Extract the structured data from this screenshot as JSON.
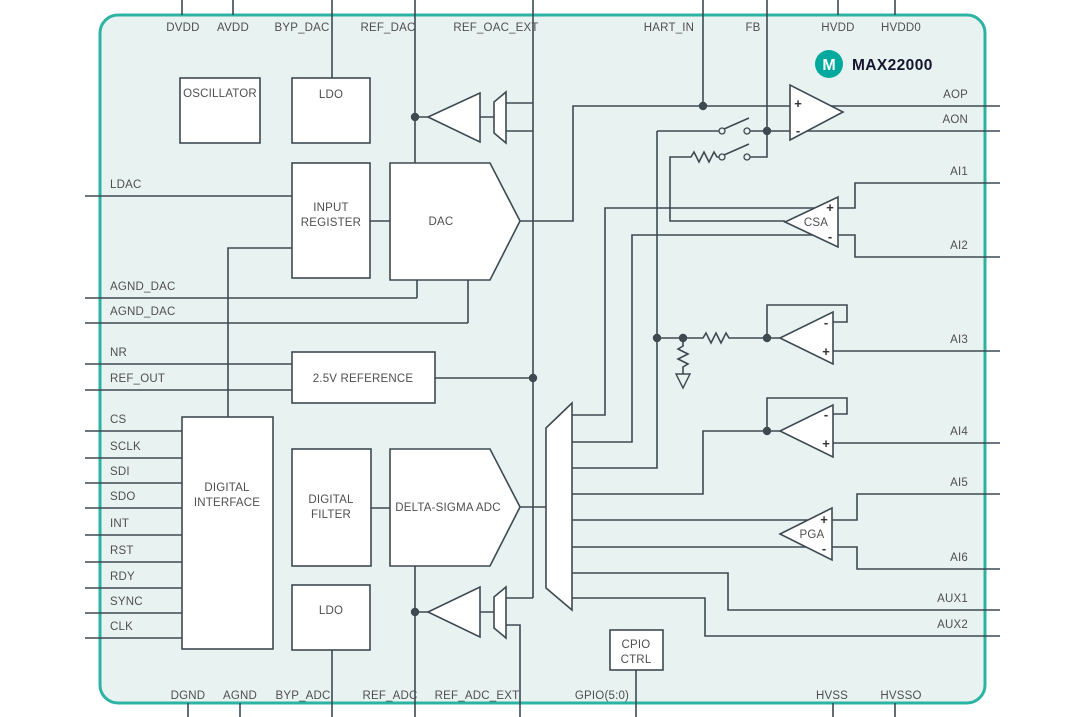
{
  "brand": {
    "part_number": "MAX22000",
    "logo_letter": "M"
  },
  "colors": {
    "border": "#2cb3a4",
    "chipfill": "#e8f2f0",
    "line": "#3d4a52",
    "text": "#4f4f4f",
    "brand": "#00a99d",
    "brand_text": "#15152e"
  },
  "pins": {
    "top": [
      "DVDD",
      "AVDD",
      "BYP_DAC",
      "REF_DAC",
      "REF_OAC_EXT",
      "HART_IN",
      "FB",
      "HVDD",
      "HVDD0"
    ],
    "bottom": [
      "DGND",
      "AGND",
      "BYP_ADC",
      "REF_ADC",
      "REF_ADC_EXT",
      "GPIO(5:0)",
      "HVSS",
      "HVSSO"
    ],
    "left": [
      "LDAC",
      "AGND_DAC",
      "AGND_DAC",
      "NR",
      "REF_OUT",
      "CS",
      "SCLK",
      "SDI",
      "SDO",
      "INT",
      "RST",
      "RDY",
      "SYNC",
      "CLK"
    ],
    "right": [
      "AOP",
      "AON",
      "AI1",
      "AI2",
      "AI3",
      "AI4",
      "AI5",
      "AI6",
      "AUX1",
      "AUX2"
    ]
  },
  "blocks": {
    "oscillator": "OSCILLATOR",
    "ldo_dac": "LDO",
    "input_register": [
      "INPUT",
      "REGISTER"
    ],
    "dac": "DAC",
    "reference": "2.5V REFERENCE",
    "digital_interface": [
      "DIGITAL",
      "INTERFACE"
    ],
    "digital_filter": [
      "DIGITAL",
      "FILTER"
    ],
    "adc": "DELTA-SIGMA ADC",
    "ldo_adc": "LDO",
    "gpio_ctrl": [
      "CPIO",
      "CTRL"
    ],
    "csa": "CSA",
    "pga": "PGA"
  },
  "glyphs": {
    "plus": "+",
    "minus": "-"
  }
}
